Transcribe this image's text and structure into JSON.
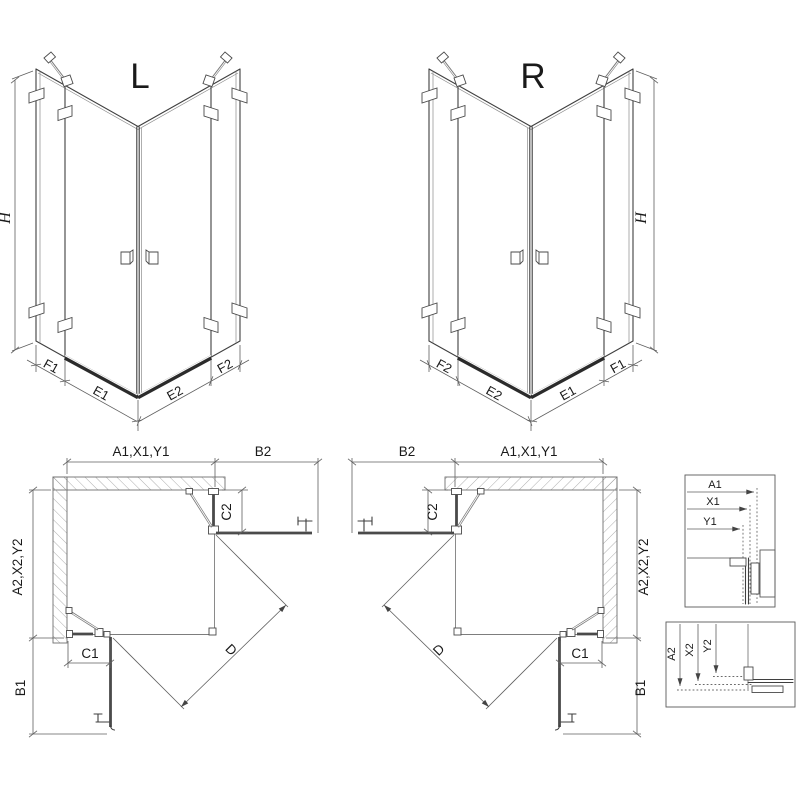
{
  "drawing": {
    "iso_left": {
      "label": "L",
      "height_dim": "H",
      "bottom_dims": [
        "F1",
        "E1",
        "E2",
        "F2"
      ]
    },
    "iso_right": {
      "label": "R",
      "height_dim": "H",
      "bottom_dims": [
        "F2",
        "E2",
        "E1",
        "F1"
      ]
    },
    "plan_left": {
      "top_width": "A1,X1,Y1",
      "door_top": "B2",
      "side_width": "A2,X2,Y2",
      "door_side": "B1",
      "fixed_bottom": "C1",
      "fixed_right": "C2",
      "diagonal": "D"
    },
    "plan_right": {
      "top_width": "A1,X1,Y1",
      "door_top": "B2",
      "side_width": "A2,X2,Y2",
      "door_side": "B1",
      "fixed_bottom": "C1",
      "fixed_right": "C2",
      "diagonal": "D"
    },
    "detail_top": {
      "dims": [
        "A1",
        "X1",
        "Y1"
      ]
    },
    "detail_bottom": {
      "dims": [
        "A2",
        "X2",
        "Y2"
      ]
    }
  },
  "colors": {
    "line": "#3f3f3f",
    "dim": "#5f5f5f",
    "hatch": "#999999",
    "rail": "#2b2b2b",
    "text": "#1a1a1a",
    "background": "#ffffff"
  }
}
